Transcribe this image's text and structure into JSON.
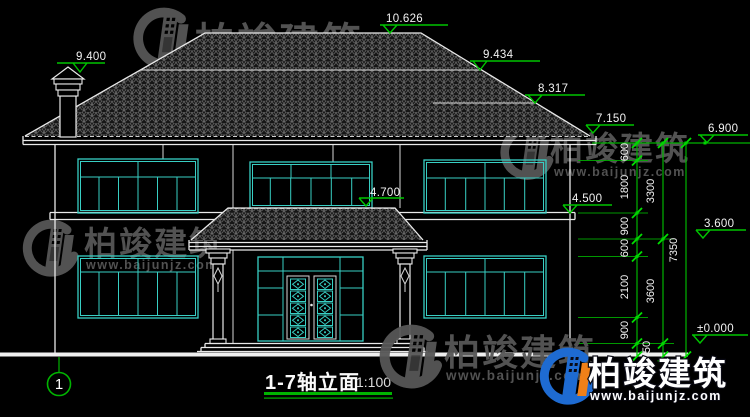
{
  "meta": {
    "drawing_name": "1-7轴立面",
    "scale_label": "1:100",
    "axis_bubble": "1"
  },
  "levels": {
    "chimney": "9.400",
    "ridge": "10.626",
    "upper_ridge_2": "9.434",
    "upper_ridge_3": "8.317",
    "main_eave": "7.150",
    "eave_wall": "6.900",
    "porch_roof": "4.700",
    "second_floor": "4.500",
    "window_head": "3.600",
    "ground_floor": "±0.000"
  },
  "dimensions": {
    "chain_a": [
      "600",
      "1800",
      "900",
      "600",
      "2100",
      "900",
      "450"
    ],
    "chain_b": [
      "3300",
      "3600"
    ],
    "overall": "7350"
  },
  "watermark": {
    "brand": "柏竣建筑",
    "website": "www.baijunjz.com"
  },
  "colors": {
    "background": "#000000",
    "cad_white": "#e9e9e9",
    "cad_cyan": "#38cfc4",
    "cad_green": "#00b400",
    "watermark_gray": "#575757",
    "logo_blue": "#1e6bd2",
    "logo_orange": "#f08018"
  }
}
